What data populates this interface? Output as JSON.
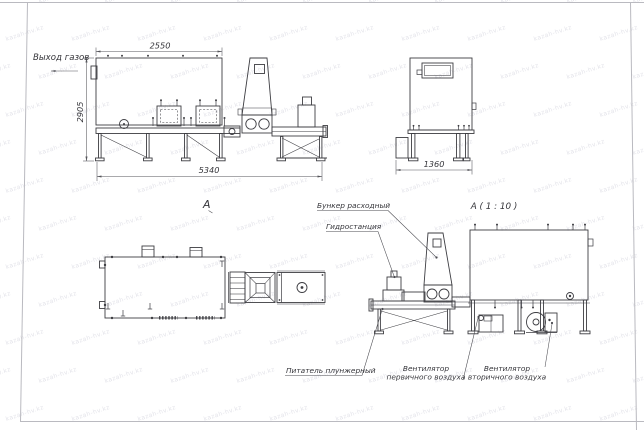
{
  "watermark": {
    "text": "kazah-hv.kz",
    "color": "#e4e4ea"
  },
  "side_view": {
    "gas_outlet_label": "Выход газов",
    "dim_width_top": "2550",
    "dim_height": "2905",
    "dim_length_total": "5340"
  },
  "end_view": {
    "dim_width": "1360"
  },
  "plan_view": {
    "view_label": "A"
  },
  "detail_view": {
    "title": "A ( 1 : 10 )",
    "callout_feed_hopper": "Бункер расходный",
    "callout_hydraulic_station": "Гидростанция",
    "callout_plunger_feeder": "Питатель плунжерный",
    "callout_primary_air_fan_line1": "Вентилятор",
    "callout_primary_air_fan_line2": "первичного воздуха",
    "callout_secondary_air_fan_line1": "Вентилятор",
    "callout_secondary_air_fan_line2": "вторичного воздуха"
  },
  "colors": {
    "line": "#3d3d42",
    "dim": "#55555a",
    "frame": "#babac0",
    "watermark": "#e4e4ea"
  }
}
